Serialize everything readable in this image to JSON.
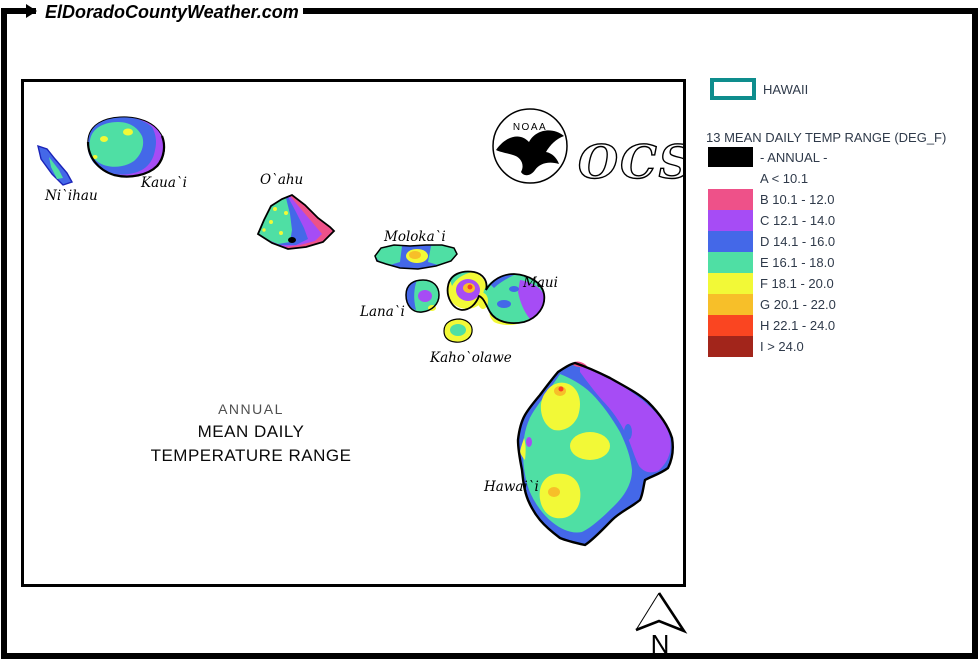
{
  "header": {
    "site_title": "ElDoradoCountyWeather.com"
  },
  "map": {
    "island_labels": [
      "Ni`ihau",
      "Kaua`i",
      "O`ahu",
      "Moloka`i",
      "Lana`i",
      "Maui",
      "Kaho`olawe",
      "Hawai`i"
    ],
    "annotation": {
      "line1": "ANNUAL",
      "line2": "MEAN DAILY",
      "line3": "TEMPERATURE RANGE"
    },
    "noaa_label": "NOAA",
    "ocs_label": "OCS"
  },
  "legend": {
    "region_box_label": "HAWAII",
    "title": "13 MEAN DAILY TEMP RANGE (DEG_F)",
    "annual_label": "- ANNUAL -",
    "annual_color": "#000000",
    "classes": [
      {
        "label": "A < 10.1",
        "color": "#FFFFFF"
      },
      {
        "label": "B 10.1 - 12.0",
        "color": "#EE5189"
      },
      {
        "label": "C 12.1 - 14.0",
        "color": "#A64CF5"
      },
      {
        "label": "D 14.1 - 16.0",
        "color": "#4468E8"
      },
      {
        "label": "E 16.1 - 18.0",
        "color": "#4FDFA4"
      },
      {
        "label": "F 18.1 - 20.0",
        "color": "#F2F937"
      },
      {
        "label": "G 20.1 - 22.0",
        "color": "#F7BF29"
      },
      {
        "label": "H 22.1 - 24.0",
        "color": "#FA4521"
      },
      {
        "label": "I > 24.0",
        "color": "#A2251B"
      }
    ]
  },
  "compass": {
    "label": "N"
  },
  "palette": {
    "pink": "#EE5189",
    "purple": "#A64CF5",
    "blue": "#4468E8",
    "green": "#4FDFA4",
    "yellow": "#F2F937",
    "orange": "#F7BF29",
    "red": "#FA4521",
    "darkred": "#A2251B",
    "teal": "#0E8D8D"
  }
}
